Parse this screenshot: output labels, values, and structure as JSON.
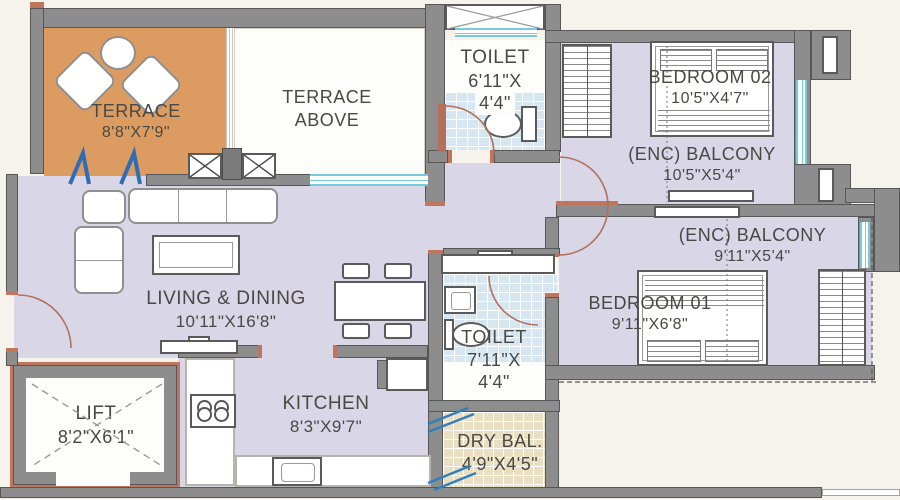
{
  "plan_title": "2BHK apartment floor plan",
  "rooms": {
    "terrace": {
      "name": "TERRACE",
      "dims": "8'8\"X7'9\""
    },
    "terrace_above": {
      "line1": "TERRACE",
      "line2": "ABOVE"
    },
    "toilet_top": {
      "name": "TOILET",
      "dims_line1": "6'11\"X",
      "dims_line2": "4'4\""
    },
    "bedroom_02": {
      "name": "BEDROOM 02",
      "dims": "10'5\"X4'7\""
    },
    "balcony_upper": {
      "name": "(ENC) BALCONY",
      "dims": "10'5\"X5'4\""
    },
    "balcony_lower": {
      "name": "(ENC) BALCONY",
      "dims": "9'11\"X5'4\""
    },
    "bedroom_01": {
      "name": "BEDROOM 01",
      "dims": "9'11\"X6'8\""
    },
    "living_dining": {
      "name": "LIVING & DINING",
      "dims": "10'11\"X16'8\""
    },
    "toilet_bottom": {
      "name": "TOILET",
      "dims_line1": "7'11\"X",
      "dims_line2": "4'4\""
    },
    "kitchen": {
      "name": "KITCHEN",
      "dims": "8'3\"X9'7\""
    },
    "dry_balcony": {
      "name": "DRY BAL.",
      "dims": "4'9\"X4'5\""
    },
    "lift": {
      "name": "LIFT",
      "dims": "8'2\"X6'1\""
    }
  },
  "colors": {
    "background": "#f6f3ed",
    "wall": "#8d8d8d",
    "wall_edge": "#565656",
    "floor_lavender": "#d9d6e8",
    "terrace_orange": "#dc9c61",
    "toilet_tile_blue": "#d6e7f2",
    "dry_tile_tan": "#eadfc2",
    "window_cyan": "#76ccdc",
    "door_swing_red": "#b4705a",
    "fold_door_blue": "#2e6db4",
    "text": "#494843"
  }
}
